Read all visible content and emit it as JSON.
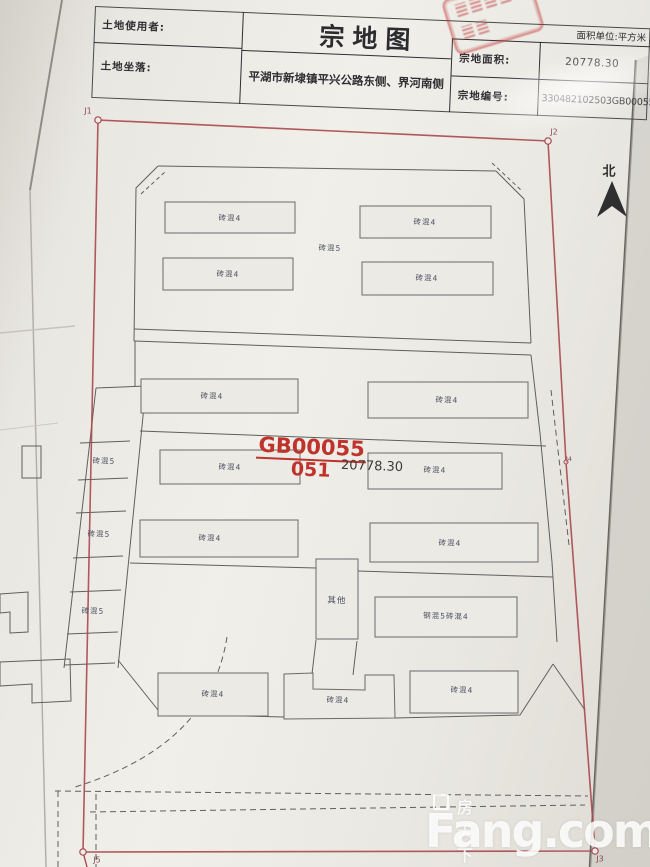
{
  "document": {
    "title": "宗地图",
    "fields": {
      "land_user_label": "土地使用者:",
      "land_user_value": "",
      "land_location_label": "土地坐落:",
      "land_location_value": "平湖市新埭镇平兴公路东侧、界河南侧",
      "area_unit_note": "面积单位:平方米",
      "parcel_area_label": "宗地面积:",
      "parcel_area_value": "20778.30",
      "parcel_number_label": "宗地编号:",
      "parcel_number_value": "330482102503GB00055"
    }
  },
  "map": {
    "north_label": "北",
    "parcel_annotation": {
      "code": "GB00055",
      "sub_code": "051",
      "area": "20778.30"
    },
    "boundary_points": {
      "j1": "J1",
      "j2": "J2",
      "j3": "J3",
      "j4": "J4",
      "j5": "J5"
    },
    "building_labels": [
      "砖混4",
      "砖混4",
      "砖混5",
      "砖混4",
      "砖混4",
      "砖混4",
      "砖混4",
      "砖混4",
      "砖混4",
      "砖混4",
      "砖混4",
      "其他",
      "钢混5砖混4",
      "砖混5",
      "砖混5",
      "砖混5",
      "砖混4",
      "砖混4",
      "砖混4"
    ],
    "colors": {
      "boundary_red": "#a8484e",
      "annotation_red": "#bf332c",
      "outline_black": "#5f5f5f"
    }
  },
  "watermark": {
    "brand_cn": "房天下",
    "brand_en": "Fang.com"
  }
}
